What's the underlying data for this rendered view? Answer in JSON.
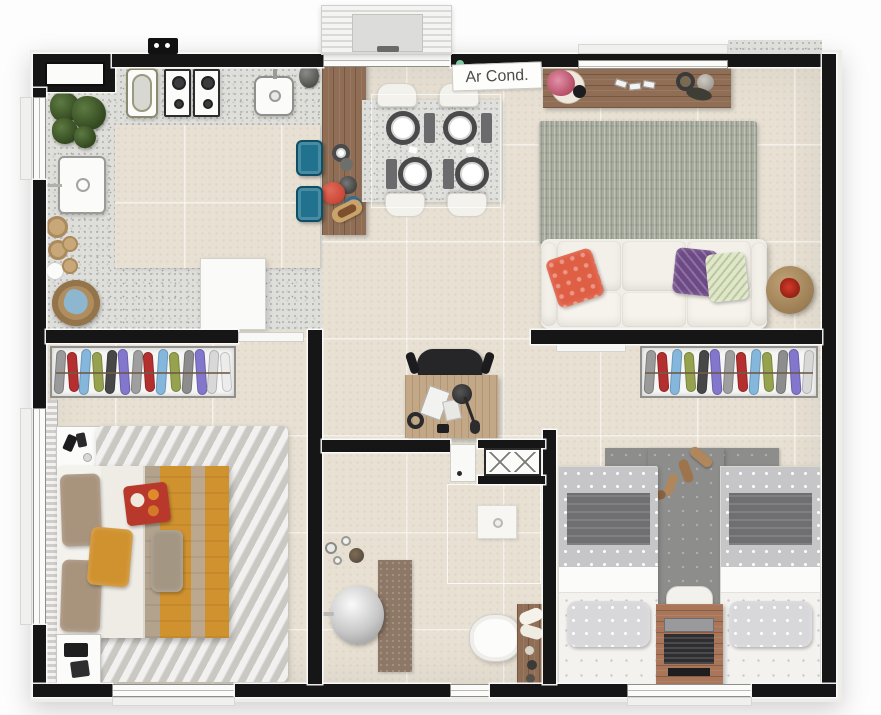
{
  "floor_plan": {
    "air_cond_label": "Ar Cond.",
    "colors": {
      "wall": "#161616",
      "tile_floor": "#e7e0d3",
      "granite_floor": "#dededb",
      "wood": "#8f6e55",
      "wood_light": "#c2a887",
      "stool": "#20728e",
      "sofa_cream": "#f1eee7",
      "living_rug": "#a9ad9f",
      "master_rug": "#dad8d4",
      "kids_rug": "#8d8d8b",
      "blanket_mustard": "#d0922f",
      "blanket_tan": "#b3a28c",
      "pillow_coral": "#df5f45",
      "pillow_purple": "#6d4a86",
      "pillow_green": "#dfe7c8",
      "kettle_red": "#c2392b",
      "clothes": [
        "#9a9a9a",
        "#b42f2f",
        "#85b7dc",
        "#97a24f",
        "#474747",
        "#8376cd",
        "#9f9f9f",
        "#b42f2f",
        "#85b7dc",
        "#97a24f",
        "#8d8d8d",
        "#8376cd",
        "#d8d8d8",
        "#ececec"
      ]
    }
  }
}
